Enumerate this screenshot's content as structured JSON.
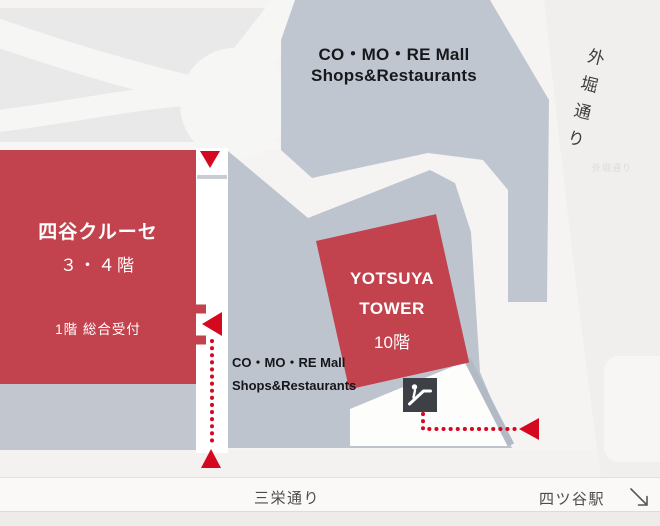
{
  "map": {
    "buildings": {
      "comore_main": {
        "line1": "CO・MO・RE Mall",
        "line2": "Shops&Restaurants"
      },
      "comore_podium": {
        "line1": "CO・MO・RE Mall",
        "line2": "Shops&Restaurants"
      },
      "yotsuya_cruce": {
        "name": "四谷クルーセ",
        "floors": "３・４階",
        "reception": "1階 総合受付"
      },
      "yotsuya_tower": {
        "line1": "YOTSUYA",
        "line2": "TOWER",
        "floors": "10階"
      }
    },
    "streets": {
      "sotobori": "外堀通り",
      "sotobori_small": "外堀通り",
      "sanei": "三栄通り",
      "station": "四ツ谷駅"
    },
    "icons": {
      "escalator": "escalator-icon",
      "station_direction": "down-right-arrow"
    },
    "colors": {
      "building_red": "#c2434d",
      "building_gray": "#c0c6cf",
      "route_red": "#d40920",
      "icon_bg": "#3d4145",
      "road_white": "#f6f6f5",
      "block_gray": "#e9e9ea"
    }
  }
}
